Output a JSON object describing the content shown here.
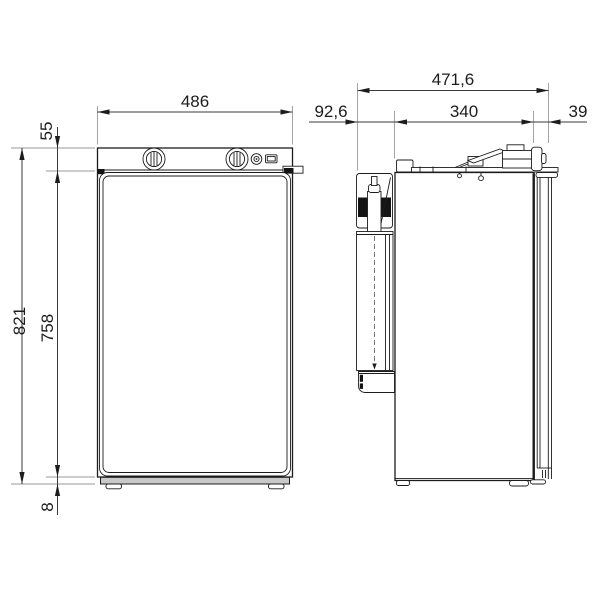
{
  "dimensions": {
    "front": {
      "width": "486",
      "control_panel_height": "55",
      "overall_height": "821",
      "door_height": "758",
      "base_gap": "8"
    },
    "side": {
      "overall_depth": "471,6",
      "cooling_unit_depth": "92,6",
      "cabinet_depth": "340",
      "door_depth": "39"
    }
  }
}
